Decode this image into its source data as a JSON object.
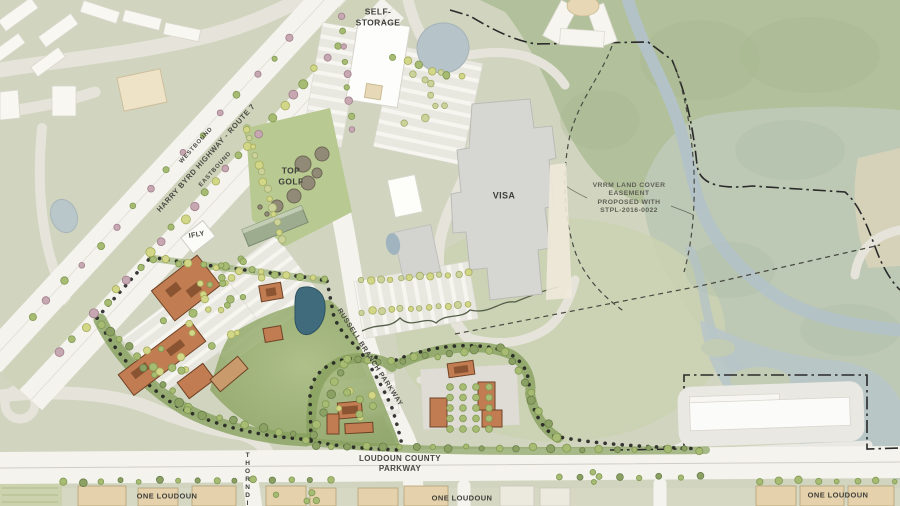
{
  "labels": {
    "self_storage": "SELF-STORAGE",
    "top_golf": "TOP GOLF",
    "visa": "VISA",
    "ifly": "IFLY",
    "vrrm_easement": "VRRM LAND COVER EASEMENT PROPOSED WITH STPL-2016-0022",
    "one_loudoun": "ONE LOUDOUN",
    "thorndike": "THORNDIKE"
  },
  "roads": {
    "westbound": "WESTBOUND",
    "eastbound": "EASTBOUND",
    "harry_byrd": "HARRY BYRD HIGHWAY - ROUTE 7",
    "russell_branch": "RUSSELL BRANCH PARKWAY",
    "loudoun_county": "LOUDOUN COUNTY PARKWAY"
  },
  "colors": {
    "base_sage": "#d1d5bf",
    "forest_green": "#b2c19b",
    "wetland": "#bdc8b5",
    "water_light": "#b3c3c8",
    "pond_dark": "#3f6b7d",
    "road_white": "#f4f3ee",
    "building_orange": "#c17c51",
    "building_gray": "#d6d6d3",
    "building_tan": "#e5d2ac",
    "topgolf_green": "#b8c992",
    "buffer_green": "#87a05e",
    "boundary_black": "#1f1f1f"
  }
}
